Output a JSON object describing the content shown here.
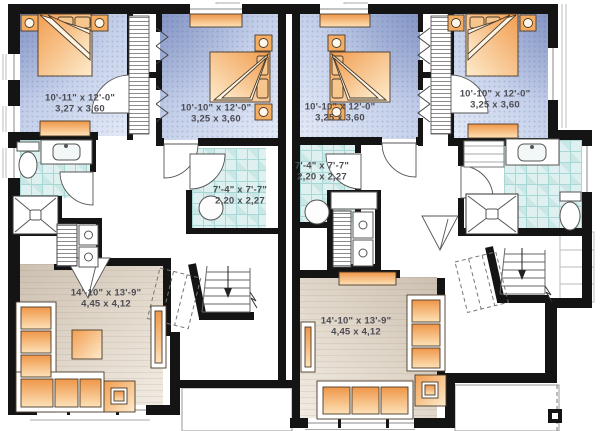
{
  "plan": {
    "type": "duplex-floor-plan",
    "units": {
      "left": {
        "bedroom_1": {
          "imperial": "10'-11\" x 12'-0\"",
          "metric": "3,27 x 3,60"
        },
        "bedroom_2": {
          "imperial": "10'-10\" x 12'-0\"",
          "metric": "3,25 x 3,60"
        },
        "bathroom": {
          "imperial": "7'-4\" x 7'-7\"",
          "metric": "2,20 x 2,27"
        },
        "living_room": {
          "imperial": "14'-10\" x 13'-9\"",
          "metric": "4,45 x 4,12"
        }
      },
      "right": {
        "bedroom_1": {
          "imperial": "10'-10\" x 12'-0\"",
          "metric": "3,25 x 3,60"
        },
        "bedroom_2": {
          "imperial": "10'-10\" x 12'-0\"",
          "metric": "3,25 x 3,60"
        },
        "bathroom": {
          "imperial": "7'-4\" x 7'-7\"",
          "metric": "2,20 x 2,27"
        },
        "living_room": {
          "imperial": "14'-10\" x 13'-9\"",
          "metric": "4,45 x 4,12"
        }
      }
    },
    "colors": {
      "wall": "#141414",
      "bedroom_floor_dark": "#a4b3db",
      "bedroom_floor_light": "#e4eaf7",
      "bathroom_tile": "#def1f0",
      "bathroom_tile_line": "#a7d8d5",
      "living_floor_dark": "#ccc0b1",
      "living_floor_light": "#f1ebe2",
      "furniture_orange": "#f09a4c",
      "furniture_orange_light": "#fde2b8"
    }
  }
}
